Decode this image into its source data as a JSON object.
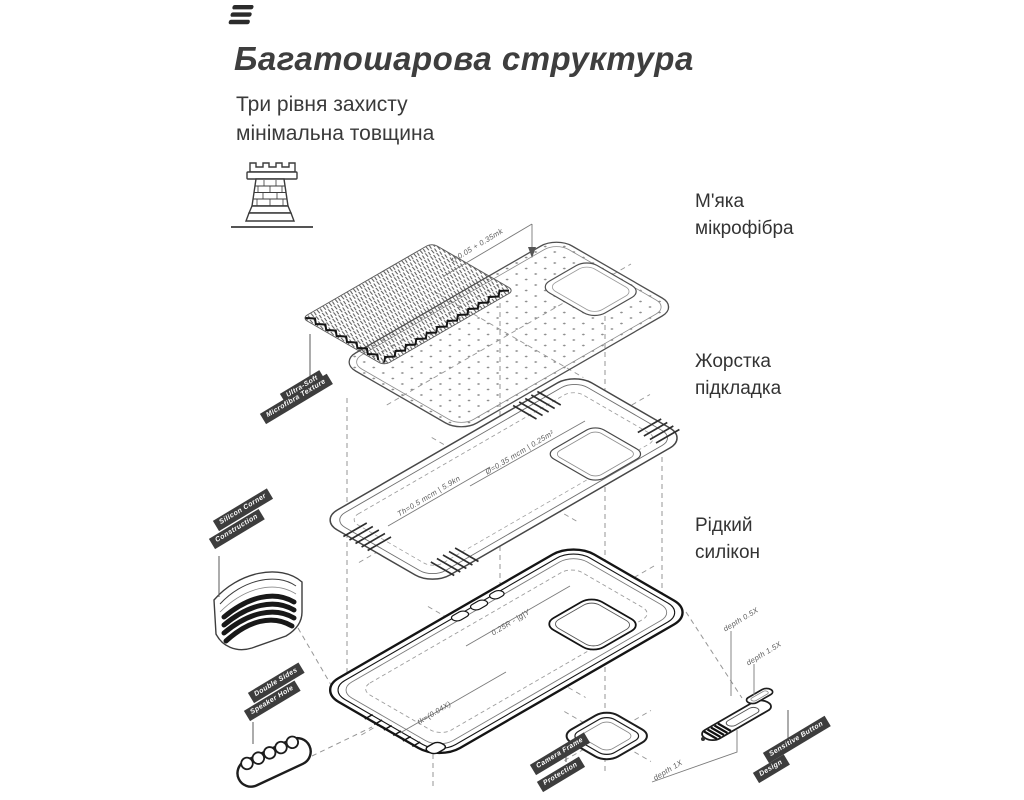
{
  "header": {
    "title": "Багатошарова структура",
    "subtitle": [
      "Три рівня захисту",
      "мінімальна товщина"
    ]
  },
  "layer_labels": [
    {
      "lines": [
        "М'яка",
        "мікрофібра"
      ]
    },
    {
      "lines": [
        "Жорстка",
        "підкладка"
      ]
    },
    {
      "lines": [
        "Рідкий",
        "силікон"
      ]
    }
  ],
  "feature_tags": {
    "microfiber": [
      "Ultra-Soft",
      "Microfibra Texture"
    ],
    "corner": [
      "Silicon Corner",
      "Construction"
    ],
    "speaker": [
      "Double Sides",
      "Speaker Hole"
    ],
    "camera": [
      "Camera Frame",
      "Protection"
    ],
    "button": [
      "Sensitive Button",
      "Design"
    ]
  },
  "dimensions": {
    "microfiber_thickness": "t=0.05 + 0.35mk",
    "shell_spec": "Ø=0.35 mcm | 0.25m²",
    "shell_thickness": "Th=0.5 mcm | 5.9kn",
    "case_spec": "0.25R - |g|Y",
    "case_thickness": "tk=(0.04X)",
    "depth_a": "depth 0.5X",
    "depth_b": "depth 1.5X",
    "depth_c": "depth 1X"
  },
  "colors": {
    "ink": "#3e3e3e",
    "line": "#4f4f4f",
    "line_dark": "#141414",
    "tag_bg": "#3d3d3d"
  }
}
